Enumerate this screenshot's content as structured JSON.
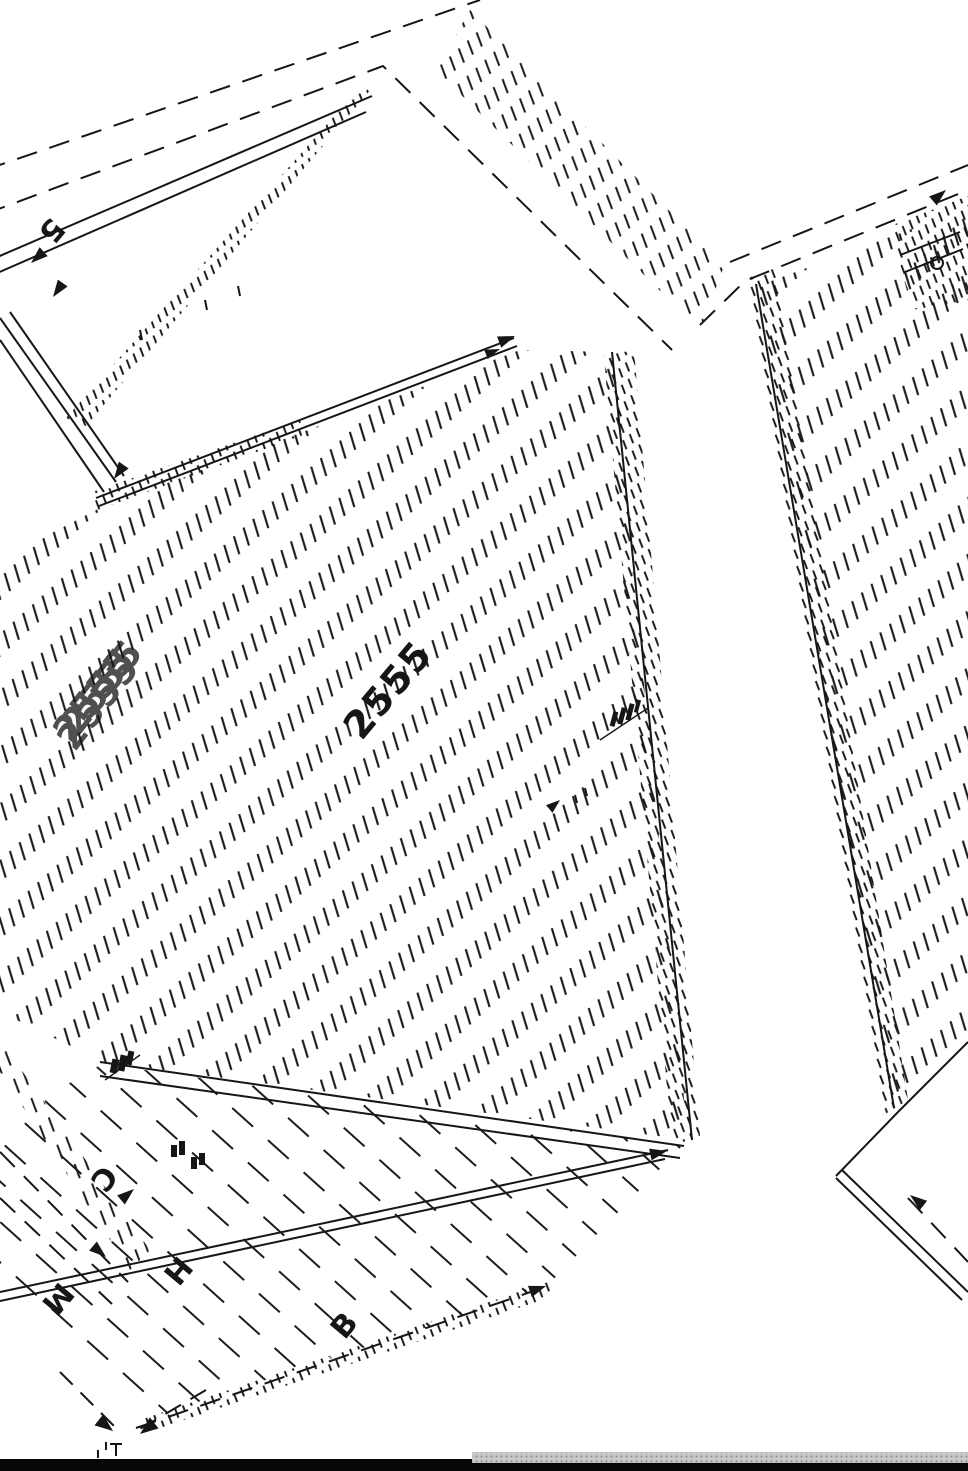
{
  "page": {
    "background": "#ffffff",
    "ink": "#161616"
  },
  "figure": {
    "type": "isometric-furniture-technical-drawing",
    "labels": {
      "top_dim": "5",
      "part_number": "2555",
      "watermark": "2555",
      "dim_c": "C",
      "dim_m": "M",
      "dim_h": "H",
      "dim_b": "B"
    }
  },
  "statusbar": {
    "left_bar_color": "#060606",
    "scrollbar_track_color": "#c4c4c4",
    "scrollbar_dot_color": "#8a8a8a"
  }
}
